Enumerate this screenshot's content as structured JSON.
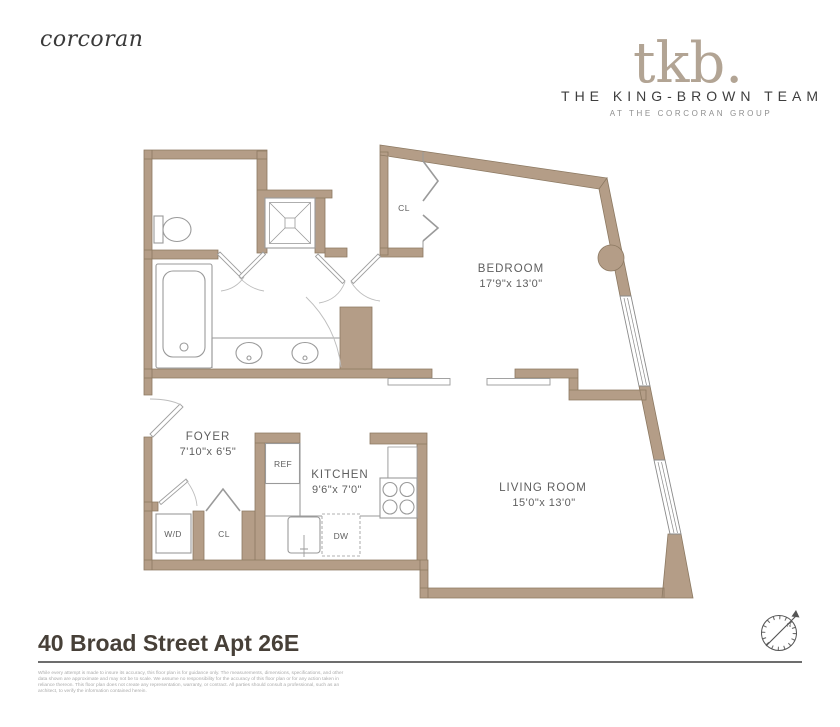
{
  "header": {
    "corcoran_logo": "corcoran",
    "tkb_logo": "tkb.",
    "team_name": "THE KING-BROWN TEAM",
    "team_subtitle": "AT THE CORCORAN GROUP"
  },
  "floorplan": {
    "rooms": {
      "bedroom": {
        "label": "BEDROOM",
        "dims": "17'9\"x 13'0\""
      },
      "living_room": {
        "label": "LIVING ROOM",
        "dims": "15'0\"x 13'0\""
      },
      "kitchen": {
        "label": "KITCHEN",
        "dims": "9'6\"x 7'0\""
      },
      "foyer": {
        "label": "FOYER",
        "dims": "7'10\"x 6'5\""
      }
    },
    "closets": {
      "bedroom_closet": "CL",
      "foyer_closet": "CL"
    },
    "appliances": {
      "washer_dryer": "W/D",
      "refrigerator": "REF",
      "dishwasher": "DW"
    },
    "compass_north": "N",
    "colors": {
      "wall_fill": "#b49d87",
      "wall_edge": "#8c7962",
      "fixture_line": "#9a9a9a",
      "label_text": "#5f5f5f",
      "logo_taupe": "#b2a494"
    }
  },
  "footer": {
    "address_title": "40 Broad Street Apt 26E",
    "disclaimer_lines": [
      "While every attempt is made to insure its accuracy, this floor plan is for guidance only. The measurements, dimensions, specifications, and other",
      "data shown are approximate and may not be to scale. We assume no responsibility for the accuracy of this floor plan or for any action taken in",
      "reliance thereon. This floor plan does not create any representation, warranty, or contract. All parties should consult a professional, such as an",
      "architect, to verify the information contained herein."
    ]
  }
}
